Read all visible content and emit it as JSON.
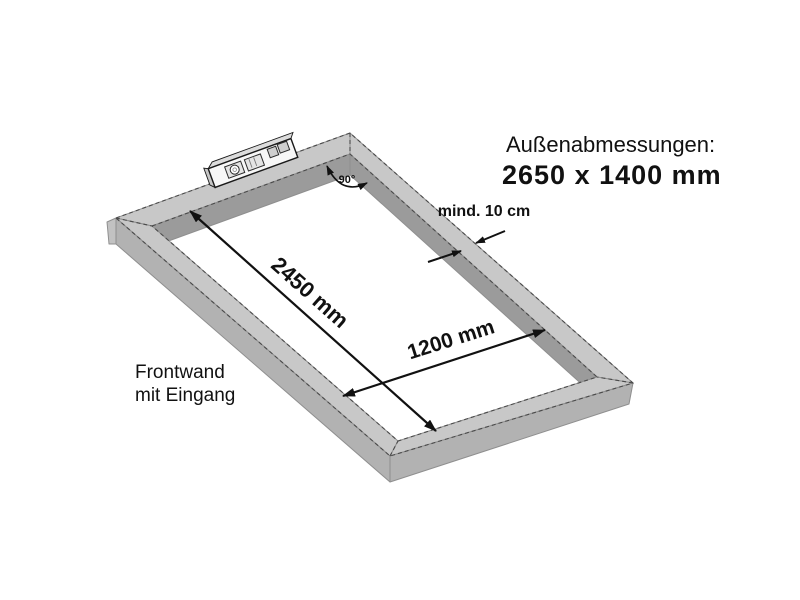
{
  "colors": {
    "background": "#ffffff",
    "top_face": "#c8c8c8",
    "inner_face": "#9b9b9b",
    "outer_face": "#b2b2b2",
    "end_face": "#c2c2c2",
    "dash_line": "#4a4a4a",
    "text": "#111111"
  },
  "header": {
    "label": "Außenabmessungen:",
    "value": "2650 x 1400 mm"
  },
  "dimensions": {
    "inner_length": "2450 mm",
    "inner_width": "1200 mm",
    "rail_min_width": "mind. 10 cm",
    "corner_angle": "90°"
  },
  "front_wall": {
    "line1": "Frontwand",
    "line2": "mit Eingang"
  },
  "icons": {
    "spirit_level": "spirit-level-icon"
  }
}
